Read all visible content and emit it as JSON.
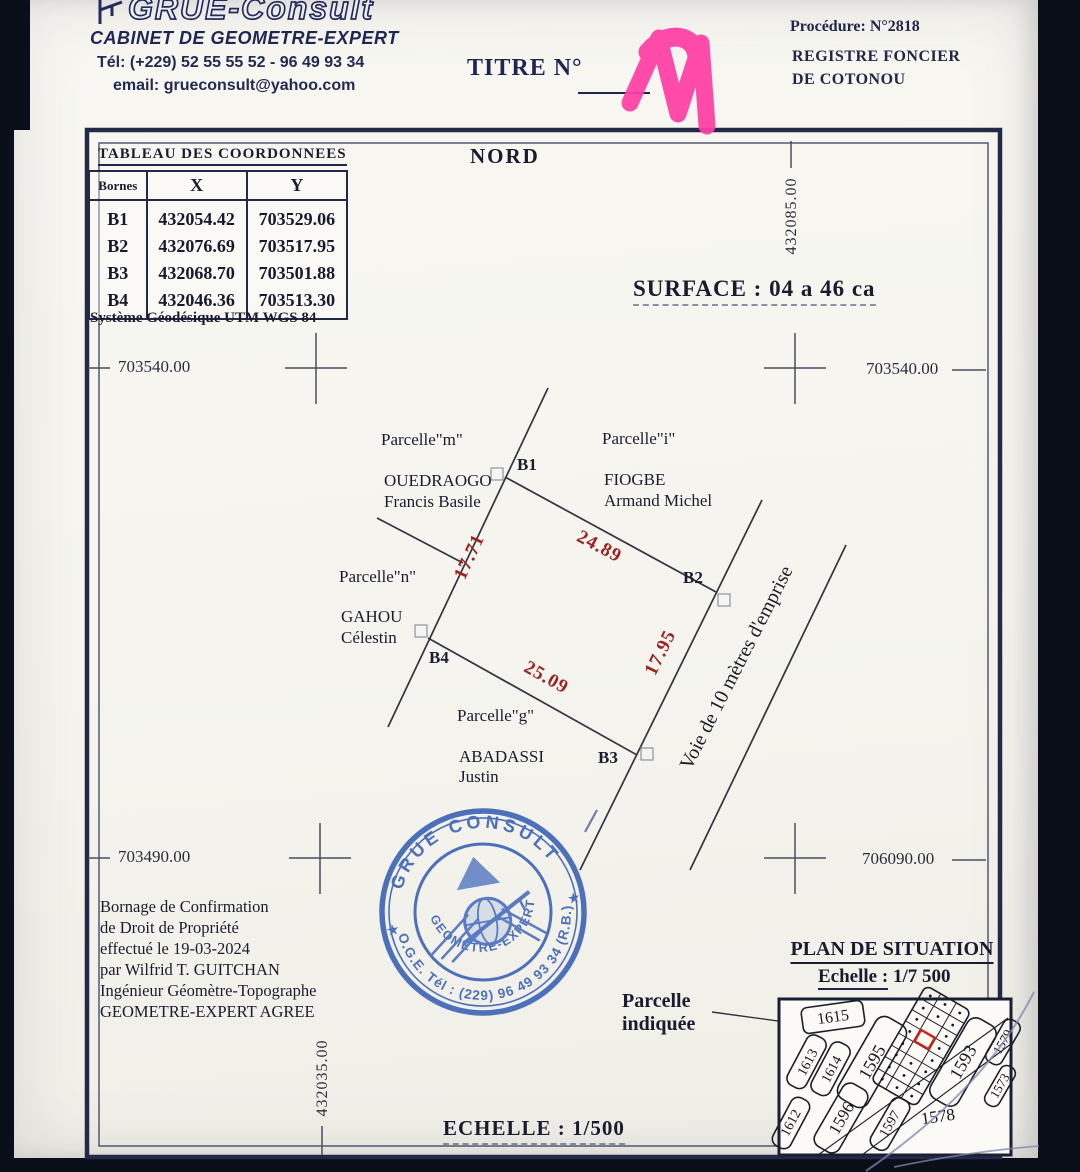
{
  "letterhead": {
    "brand": "GRUE-Consult",
    "subtitle": "CABINET DE GEOMETRE-EXPERT",
    "phone": "Tél:  (+229) 52 55 55 52 - 96 49 93 34",
    "email": "email:  grueconsult@yahoo.com"
  },
  "title_block": {
    "titre": "TITRE N°",
    "procedure": "Procédure: N°2818",
    "registre1": "REGISTRE FONCIER",
    "registre2": "DE COTONOU"
  },
  "coords_table": {
    "title": "TABLEAU  DES  COORDONNEES",
    "col_bornes": "Bornes",
    "col_x": "X",
    "col_y": "Y",
    "rows": [
      {
        "borne": "B1",
        "x": "432054.42",
        "y": "703529.06"
      },
      {
        "borne": "B2",
        "x": "432076.69",
        "y": "703517.95"
      },
      {
        "borne": "B3",
        "x": "432068.70",
        "y": "703501.88"
      },
      {
        "borne": "B4",
        "x": "432046.36",
        "y": "703513.30"
      }
    ],
    "footer": "Système Géodésique UTM WGS 84"
  },
  "plan": {
    "north": "NORD",
    "surface": "SURFACE :  04 a 46 ca",
    "grid_labels": {
      "top_left": "703540.00",
      "top_right": "703540.00",
      "bottom_left": "703490.00",
      "bottom_right": "706090.00",
      "easting_top": "432085.00",
      "easting_bottom": "432035.00"
    },
    "corners": {
      "b1": "B1",
      "b2": "B2",
      "b3": "B3",
      "b4": "B4"
    },
    "dims": {
      "b1_b4": "17.71",
      "b1_b2": "24.89",
      "b2_b3": "17.95",
      "b4_b3": "25.09"
    },
    "neighbors": [
      {
        "parcel": "Parcelle\"m\"",
        "line1": "OUEDRAOGO",
        "line2": "Francis Basile"
      },
      {
        "parcel": "Parcelle\"i\"",
        "line1": "FIOGBE",
        "line2": "Armand Michel"
      },
      {
        "parcel": "Parcelle\"n\"",
        "line1": "GAHOU",
        "line2": "Célestin"
      },
      {
        "parcel": "Parcelle\"g\"",
        "line1": "ABADASSI",
        "line2": "Justin"
      }
    ],
    "road": "Voie de 10 mètres d'emprise",
    "scale": "ECHELLE : 1/500"
  },
  "certification": {
    "line1": "Bornage de Confirmation",
    "line2": "de Droit de Propriété",
    "line3": "effectué le 19-03-2024",
    "line4": "par Wilfrid T. GUITCHAN",
    "line5": "Ingénieur Géomètre-Topographe",
    "line6": "GEOMETRE-EXPERT AGREE"
  },
  "stamp": {
    "arc_top": "GRUE CONSULT",
    "arc_bottom": "O.G.E. Tél : (229) 96 49 93 34 (R.B.)",
    "arc_inner": "GEOMETRE-EXPERT",
    "star_left": "★",
    "star_right": "★"
  },
  "situation": {
    "title": "PLAN DE SITUATION",
    "scale_word": "Echelle :",
    "scale_value": "1/7 500",
    "callout1": "Parcelle",
    "callout2": "indiquée",
    "parcels": [
      "1615",
      "1613",
      "1614",
      "1595",
      "1593",
      "1579",
      "1573",
      "1612",
      "1596",
      "1597",
      "1578"
    ]
  },
  "colors": {
    "ink_navy": "#1f2650",
    "stamp_blue": "#3c63b5",
    "dim_red": "#9c2121",
    "highlight_pink": "#ff3fa4",
    "marker_red": "#cc2318"
  }
}
